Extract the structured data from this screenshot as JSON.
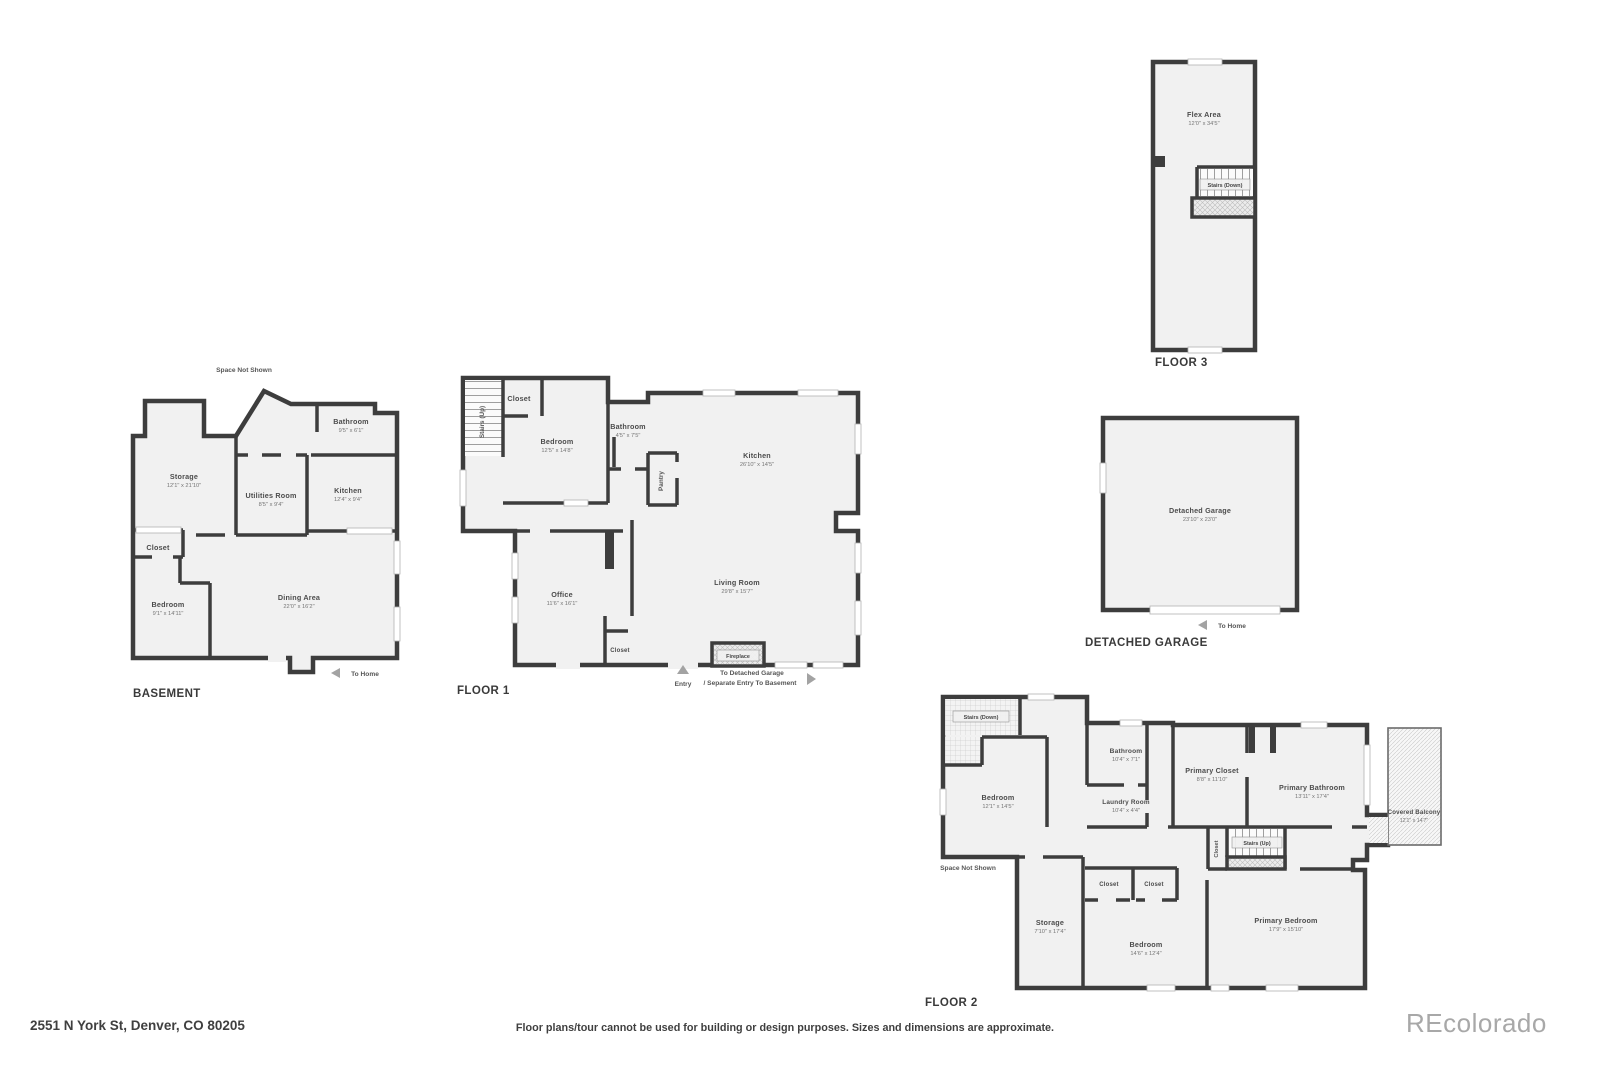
{
  "page": {
    "address": "2551 N York St, Denver, CO 80205",
    "disclaimer": "Floor plans/tour cannot be used for building or design purposes. Sizes and dimensions are approximate.",
    "watermark": "REcolorado"
  },
  "colors": {
    "wall": "#3d3d3d",
    "room_fill": "#f1f1f1",
    "watermark_gray": "#a8a8a8"
  },
  "icons": {
    "to_home_arrow": "left-triangle",
    "entry_arrow": "up-triangle",
    "to_garage_arrow": "right-triangle"
  },
  "basement": {
    "title": "BASEMENT",
    "space_not_shown": "Space Not Shown",
    "to_home": "To Home",
    "rooms": {
      "bathroom": {
        "name": "Bathroom",
        "dims": "9'5\" x 6'1\""
      },
      "storage": {
        "name": "Storage",
        "dims": "12'1\" x 21'10\""
      },
      "utilities": {
        "name": "Utilities Room",
        "dims": "8'5\" x 9'4\""
      },
      "kitchen": {
        "name": "Kitchen",
        "dims": "12'4\" x 9'4\""
      },
      "closet": {
        "name": "Closet"
      },
      "bedroom": {
        "name": "Bedroom",
        "dims": "9'1\" x 14'11\""
      },
      "dining": {
        "name": "Dining Area",
        "dims": "22'0\" x 16'2\""
      }
    }
  },
  "floor1": {
    "title": "FLOOR 1",
    "stairs_up": "Stairs (Up)",
    "entry": "Entry",
    "to_garage_line1": "To Detached Garage",
    "to_garage_line2": "/ Separate Entry To Basement",
    "rooms": {
      "closet_top": {
        "name": "Closet"
      },
      "bedroom": {
        "name": "Bedroom",
        "dims": "12'5\" x 14'8\""
      },
      "bathroom": {
        "name": "Bathroom",
        "dims": "4'5\" x 7'5\""
      },
      "pantry": {
        "name": "Pantry"
      },
      "kitchen": {
        "name": "Kitchen",
        "dims": "26'10\" x 14'5\""
      },
      "office": {
        "name": "Office",
        "dims": "11'6\" x 16'1\""
      },
      "living": {
        "name": "Living Room",
        "dims": "29'8\" x 15'7\""
      },
      "closet_bottom": {
        "name": "Closet"
      },
      "fireplace": {
        "name": "Fireplace"
      }
    }
  },
  "floor2": {
    "title": "FLOOR 2",
    "stairs_down": "Stairs (Down)",
    "stairs_up": "Stairs (Up)",
    "space_not_shown": "Space Not Shown",
    "rooms": {
      "bedroom": {
        "name": "Bedroom",
        "dims": "12'1\" x 14'5\""
      },
      "bathroom": {
        "name": "Bathroom",
        "dims": "10'4\" x 7'1\""
      },
      "laundry": {
        "name": "Laundry Room",
        "dims": "10'4\" x 4'4\""
      },
      "primary_closet": {
        "name": "Primary Closet",
        "dims": "8'8\" x 11'10\""
      },
      "primary_bathroom": {
        "name": "Primary Bathroom",
        "dims": "13'11\" x 17'4\""
      },
      "closet_hall": {
        "name": "Closet"
      },
      "balcony": {
        "name": "Covered Balcony",
        "dims": "12'1\" x 14'7\""
      },
      "storage": {
        "name": "Storage",
        "dims": "7'10\" x 17'4\""
      },
      "closet_a": {
        "name": "Closet"
      },
      "closet_b": {
        "name": "Closet"
      },
      "bedroom2": {
        "name": "Bedroom",
        "dims": "14'6\" x 12'4\""
      },
      "primary_bedroom": {
        "name": "Primary Bedroom",
        "dims": "17'9\" x 15'10\""
      }
    }
  },
  "floor3": {
    "title": "FLOOR 3",
    "stairs_down": "Stairs (Down)",
    "rooms": {
      "flex": {
        "name": "Flex Area",
        "dims": "12'0\" x 34'5\""
      }
    }
  },
  "garage": {
    "title": "DETACHED GARAGE",
    "to_home": "To Home",
    "rooms": {
      "garage": {
        "name": "Detached Garage",
        "dims": "23'10\" x 23'0\""
      }
    }
  }
}
